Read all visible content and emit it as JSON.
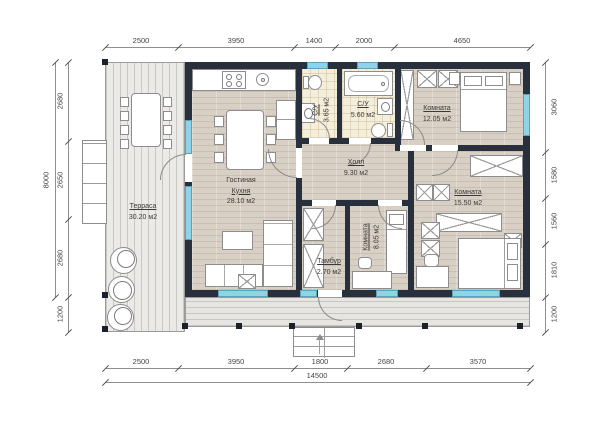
{
  "dimensions": {
    "top": [
      "2500",
      "3950",
      "1400",
      "2000",
      "4650"
    ],
    "bottom": [
      "2500",
      "3950",
      "1800",
      "2680",
      "3570"
    ],
    "bottom_total": "14500",
    "left": [
      "2680",
      "2650",
      "2680",
      "1200"
    ],
    "left_total": "8000",
    "right": [
      "3060",
      "1580",
      "1560",
      "1810",
      "1200"
    ]
  },
  "rooms": {
    "terrace": {
      "name": "Терраса",
      "area": "30.20 м2"
    },
    "living_kitchen": {
      "name_line1": "Гостиная",
      "name_line2": "Кухня",
      "area": "28.10 м2"
    },
    "bath_small": {
      "name": "С/У",
      "area": "3.65 м2"
    },
    "bath_large": {
      "name": "С/У",
      "area": "5.60 м2"
    },
    "bedroom1": {
      "name": "Комната",
      "area": "12.05 м2"
    },
    "hall": {
      "name": "Холл",
      "area": "9.30 м2"
    },
    "bedroom2": {
      "name": "Комната",
      "area": "15.50 м2"
    },
    "bedroom3": {
      "name": "Комната",
      "area": "8.05 м2"
    },
    "vestibule": {
      "name": "Тамбур",
      "area": "2.70 м2"
    }
  },
  "colors": {
    "wall": "#27303c",
    "window": "#8ed3e8",
    "wood_floor": "#d9d0c5",
    "terrace_deck": "#ebeae7",
    "bathroom_tile": "#f4eedd",
    "dimension_text": "#454545"
  }
}
